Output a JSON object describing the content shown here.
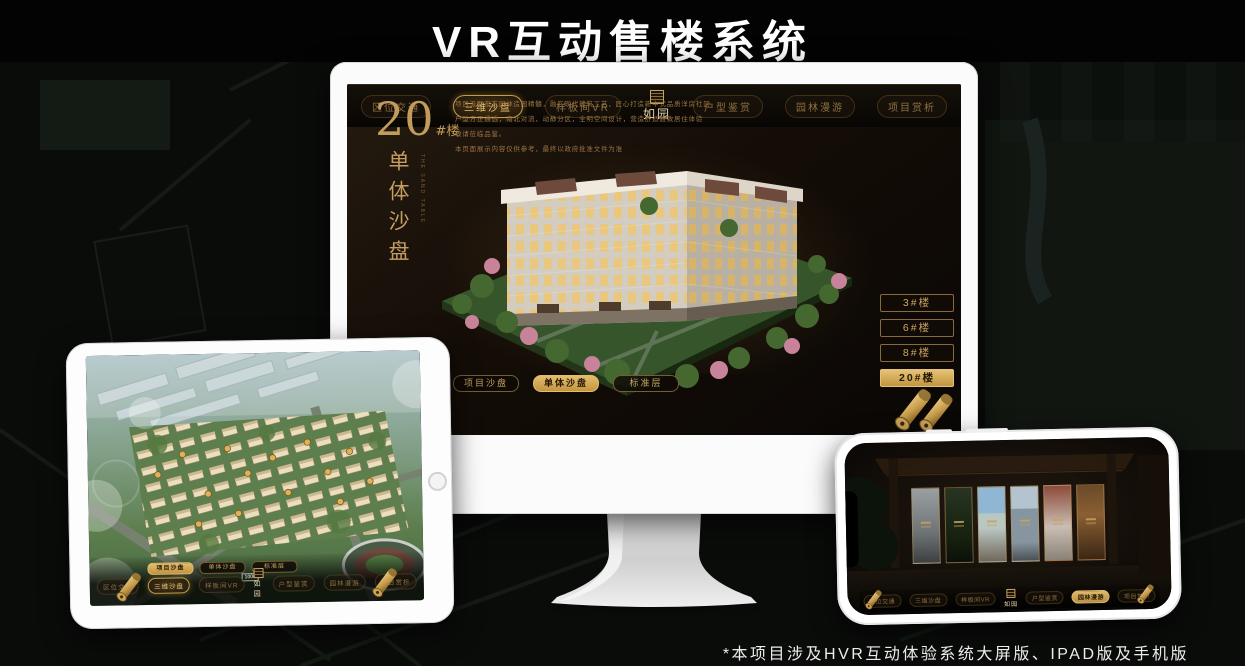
{
  "page": {
    "title": "VR互动售楼系统",
    "footnote": "*本项目涉及HVR互动体验系统大屏版、IPAD版及手机版"
  },
  "sales_ui": {
    "logo": "如园",
    "sub_tabs": [
      "项目沙盘",
      "单体沙盘",
      "标准层"
    ],
    "nav_items": [
      "区位交通",
      "三维沙盘",
      "样板间VR",
      "户型鉴赏",
      "园林漫游",
      "项目赏析"
    ],
    "colors": {
      "gold": "#d2a95e",
      "gold_dark": "#8a6a3a",
      "screen_bg": "#16100a"
    }
  },
  "monitor": {
    "block_number": "20",
    "block_suffix": "#楼",
    "block_title": "单体沙盘",
    "block_title_en": "THE SAND TABLE",
    "intro_lines": [
      "项目汲取东方园林造园精髓，融汇现代建筑工艺，匠心打造新中式品质洋房社区",
      "户型方正通透，南北对流，动静分区，全明空间设计，营造舒适雅致居住体验",
      "敬请莅临品鉴。",
      "本页面展示内容仅供参考，最终以政府批准文件为准"
    ],
    "floor_buttons": [
      "3#楼",
      "6#楼",
      "8#楼",
      "20#楼"
    ]
  },
  "tablet": {
    "scale_label": "1000"
  }
}
